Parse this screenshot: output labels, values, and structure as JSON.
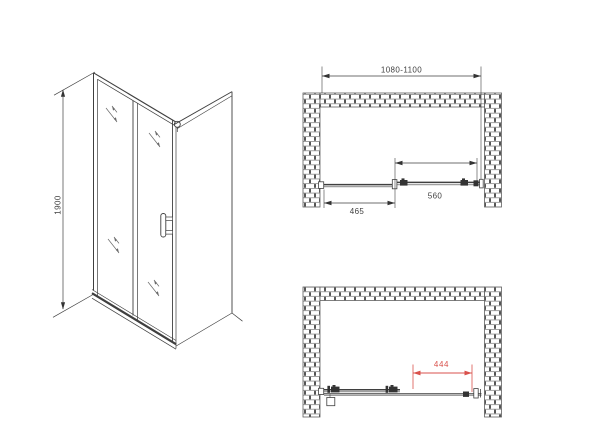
{
  "drawing": {
    "type": "shower-door-technical-drawing",
    "colors": {
      "background": "#ffffff",
      "line": "#3f3f3f",
      "dimension_red": "#d9524c"
    },
    "icons": {
      "glass_reflection": "glass-reflection-mark",
      "brick_wall": "brick-hatch-pattern",
      "dimension_arrow": "filled-triangle-arrow"
    },
    "views": {
      "isometric": {
        "name": "isometric-view"
      },
      "plan_closed": {
        "name": "top-view-door-closed"
      },
      "plan_open": {
        "name": "top-view-door-open"
      }
    },
    "dimensions": {
      "door_height": "1900",
      "overall_width_range": "1080-1100",
      "fixed_panel_width": "465",
      "sliding_panel_width": "560",
      "clear_opening_width": "444"
    }
  }
}
